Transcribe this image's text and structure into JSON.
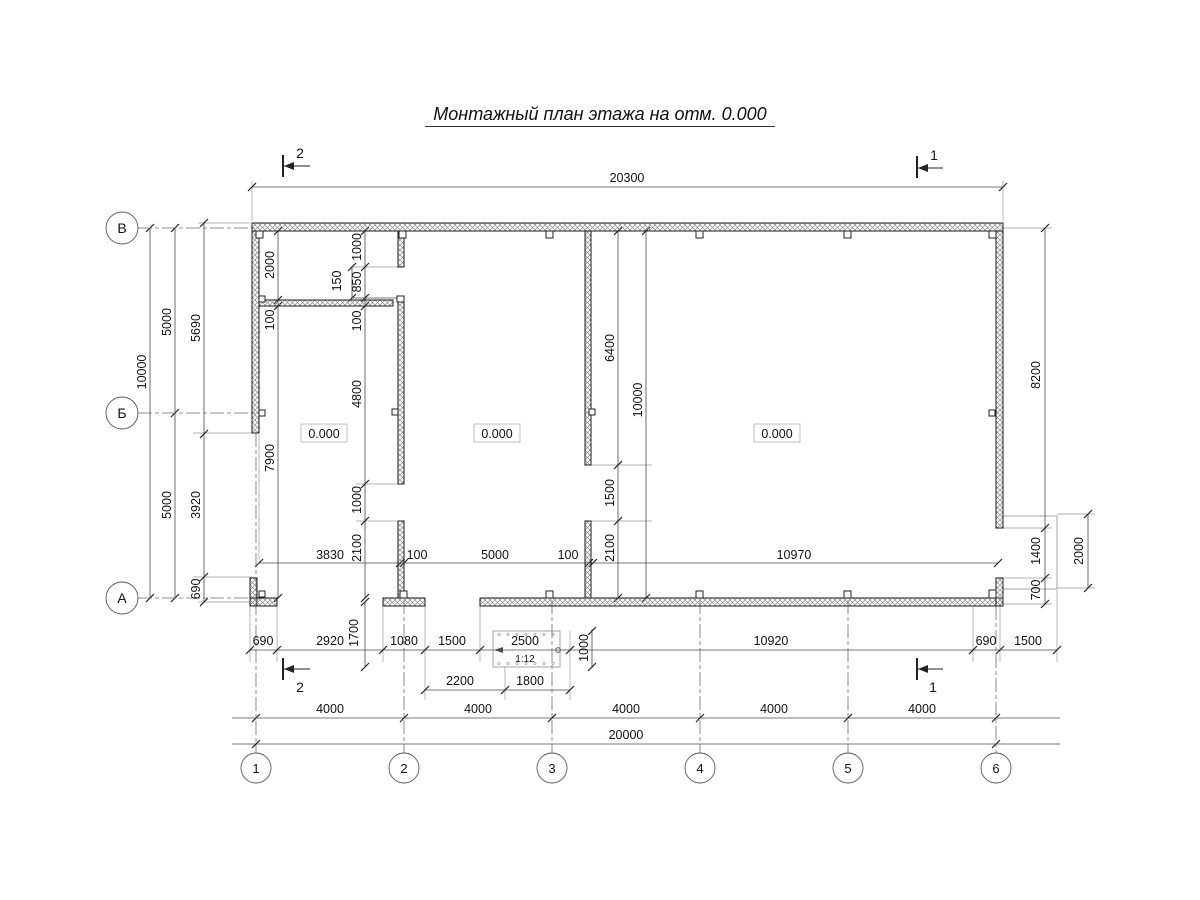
{
  "title": "Монтажный план этажа на отм. 0.000",
  "level_label": "0.000",
  "ramp_slope": "1:12",
  "plan": {
    "colors": {
      "wall_stroke": "#1a1a1a",
      "hatch": "#8a8a8a",
      "dim": "#4a4a4a",
      "ext": "#9a9a9a",
      "axis": "#6f6f6f",
      "tick": "#222222",
      "box": "#b5b5b5"
    },
    "walls": [
      [
        252,
        223,
        751,
        8
      ],
      [
        252,
        231,
        7,
        202
      ],
      [
        250,
        578,
        7,
        28
      ],
      [
        250,
        598,
        27,
        8
      ],
      [
        383,
        598,
        42,
        8
      ],
      [
        480,
        598,
        523,
        8
      ],
      [
        996,
        231,
        7,
        297
      ],
      [
        996,
        578,
        7,
        28
      ],
      [
        398,
        231,
        6,
        36
      ],
      [
        398,
        296,
        6,
        188
      ],
      [
        398,
        521,
        6,
        77
      ],
      [
        585,
        231,
        6,
        234
      ],
      [
        585,
        521,
        6,
        77
      ],
      [
        259,
        300,
        134,
        6
      ]
    ],
    "columns": [
      [
        256,
        231,
        7,
        7
      ],
      [
        399,
        231,
        7,
        7
      ],
      [
        546,
        231,
        7,
        7
      ],
      [
        696,
        231,
        7,
        7
      ],
      [
        844,
        231,
        7,
        7
      ],
      [
        989,
        231,
        7,
        7
      ],
      [
        259,
        410,
        6,
        6
      ],
      [
        989,
        410,
        6,
        6
      ],
      [
        392,
        409,
        6,
        6
      ],
      [
        589,
        409,
        6,
        6
      ],
      [
        259,
        296,
        6,
        6
      ],
      [
        397,
        296,
        7,
        6
      ],
      [
        259,
        591,
        6,
        6
      ],
      [
        400,
        591,
        7,
        7
      ],
      [
        546,
        591,
        7,
        7
      ],
      [
        696,
        591,
        7,
        7
      ],
      [
        844,
        591,
        7,
        7
      ],
      [
        989,
        590,
        7,
        8
      ]
    ],
    "v_axes": [
      {
        "label": "1",
        "x": 256,
        "y1": 433,
        "y2": 753
      },
      {
        "label": "2",
        "x": 404,
        "y1": 600,
        "y2": 753
      },
      {
        "label": "3",
        "x": 552,
        "y1": 600,
        "y2": 753
      },
      {
        "label": "4",
        "x": 700,
        "y1": 600,
        "y2": 753
      },
      {
        "label": "5",
        "x": 848,
        "y1": 600,
        "y2": 753
      },
      {
        "label": "6",
        "x": 996,
        "y1": 606,
        "y2": 753
      }
    ],
    "v_axis_circle_y": 768,
    "h_axes": [
      {
        "label": "В",
        "y": 228,
        "x1": 138,
        "x2": 259
      },
      {
        "label": "Б",
        "y": 413,
        "x1": 138,
        "x2": 259
      },
      {
        "label": "А",
        "y": 598,
        "x1": 138,
        "x2": 252
      }
    ],
    "h_axis_circle_x": 122,
    "dim_lines": [
      {
        "x1": 252,
        "y1": 187,
        "x2": 1003,
        "y2": 187,
        "ticks": [
          [
            252,
            187
          ],
          [
            1003,
            187
          ]
        ]
      },
      {
        "x1": 259,
        "y1": 563,
        "x2": 998,
        "y2": 563,
        "ticks": [
          [
            259,
            563
          ],
          [
            400,
            563
          ],
          [
            404,
            563
          ],
          [
            589,
            563
          ],
          [
            593,
            563
          ],
          [
            998,
            563
          ]
        ]
      },
      {
        "x1": 250,
        "y1": 650,
        "x2": 1057,
        "y2": 650,
        "ticks": [
          [
            250,
            650
          ],
          [
            277,
            650
          ],
          [
            383,
            650
          ],
          [
            425,
            650
          ],
          [
            480,
            650
          ],
          [
            570,
            650
          ],
          [
            973,
            650
          ],
          [
            1000,
            650
          ],
          [
            1057,
            650
          ]
        ]
      },
      {
        "x1": 425,
        "y1": 690,
        "x2": 570,
        "y2": 690,
        "ticks": [
          [
            425,
            690
          ],
          [
            505,
            690
          ],
          [
            570,
            690
          ]
        ]
      },
      {
        "x1": 232,
        "y1": 718,
        "x2": 1060,
        "y2": 718,
        "ticks": [
          [
            256,
            718
          ],
          [
            404,
            718
          ],
          [
            552,
            718
          ],
          [
            700,
            718
          ],
          [
            848,
            718
          ],
          [
            996,
            718
          ]
        ]
      },
      {
        "x1": 232,
        "y1": 744,
        "x2": 1060,
        "y2": 744,
        "ticks": [
          [
            256,
            744
          ],
          [
            996,
            744
          ]
        ]
      },
      {
        "x1": 150,
        "y1": 228,
        "x2": 150,
        "y2": 598,
        "ticks": [
          [
            150,
            228
          ],
          [
            150,
            598
          ]
        ]
      },
      {
        "x1": 175,
        "y1": 228,
        "x2": 175,
        "y2": 598,
        "ticks": [
          [
            175,
            228
          ],
          [
            175,
            413
          ],
          [
            175,
            598
          ]
        ]
      },
      {
        "x1": 204,
        "y1": 223,
        "x2": 204,
        "y2": 602,
        "ticks": [
          [
            204,
            223
          ],
          [
            204,
            434
          ],
          [
            204,
            577
          ],
          [
            204,
            602
          ]
        ]
      },
      {
        "x1": 278,
        "y1": 231,
        "x2": 278,
        "y2": 598,
        "ticks": [
          [
            278,
            231
          ],
          [
            278,
            300
          ],
          [
            278,
            306
          ],
          [
            278,
            598
          ]
        ]
      },
      {
        "x1": 365,
        "y1": 231,
        "x2": 365,
        "y2": 598,
        "ticks": [
          [
            365,
            231
          ],
          [
            365,
            267
          ],
          [
            365,
            298
          ],
          [
            365,
            306
          ],
          [
            365,
            484
          ],
          [
            365,
            521
          ],
          [
            365,
            598
          ]
        ]
      },
      {
        "x1": 352,
        "y1": 267,
        "x2": 352,
        "y2": 298,
        "ticks": [
          [
            352,
            267
          ],
          [
            352,
            298
          ]
        ]
      },
      {
        "x1": 352,
        "y1": 298,
        "x2": 397,
        "y2": 298,
        "ticks": []
      },
      {
        "x1": 618,
        "y1": 231,
        "x2": 618,
        "y2": 598,
        "ticks": [
          [
            618,
            231
          ],
          [
            618,
            465
          ],
          [
            618,
            521
          ],
          [
            618,
            598
          ]
        ]
      },
      {
        "x1": 646,
        "y1": 231,
        "x2": 646,
        "y2": 598,
        "ticks": [
          [
            646,
            231
          ],
          [
            646,
            598
          ]
        ]
      },
      {
        "x1": 365,
        "y1": 602,
        "x2": 365,
        "y2": 667,
        "ticks": [
          [
            365,
            602
          ],
          [
            365,
            667
          ]
        ]
      },
      {
        "x1": 592,
        "y1": 629,
        "x2": 592,
        "y2": 668,
        "ticks": [
          [
            592,
            631
          ],
          [
            592,
            667
          ]
        ]
      },
      {
        "x1": 1045,
        "y1": 228,
        "x2": 1045,
        "y2": 604,
        "ticks": [
          [
            1045,
            228
          ],
          [
            1045,
            528
          ],
          [
            1045,
            578
          ],
          [
            1045,
            604
          ]
        ]
      },
      {
        "x1": 1088,
        "y1": 514,
        "x2": 1088,
        "y2": 588,
        "ticks": [
          [
            1088,
            514
          ],
          [
            1088,
            588
          ]
        ]
      }
    ],
    "ext_lines": [
      [
        252,
        221,
        252,
        181
      ],
      [
        1003,
        221,
        1003,
        181
      ],
      [
        250,
        223,
        198,
        223
      ],
      [
        259,
        433,
        193,
        433
      ],
      [
        252,
        577,
        193,
        577
      ],
      [
        250,
        602,
        198,
        602
      ],
      [
        404,
        267,
        350,
        267
      ],
      [
        398,
        484,
        356,
        484
      ],
      [
        398,
        521,
        356,
        521
      ],
      [
        591,
        465,
        652,
        465
      ],
      [
        591,
        521,
        652,
        521
      ],
      [
        259,
        435,
        259,
        560
      ],
      [
        250,
        606,
        250,
        662
      ],
      [
        277,
        606,
        277,
        662
      ],
      [
        383,
        606,
        383,
        662
      ],
      [
        425,
        606,
        425,
        700
      ],
      [
        480,
        606,
        480,
        662
      ],
      [
        505,
        667,
        505,
        700
      ],
      [
        570,
        631,
        570,
        700
      ],
      [
        973,
        606,
        973,
        662
      ],
      [
        1000,
        606,
        1000,
        662
      ],
      [
        1057,
        590,
        1057,
        662
      ],
      [
        1003,
        228,
        1052,
        228
      ],
      [
        1003,
        528,
        1052,
        528
      ],
      [
        1003,
        578,
        1052,
        578
      ],
      [
        1003,
        604,
        1052,
        604
      ],
      [
        1057,
        514,
        1095,
        514
      ],
      [
        1057,
        588,
        1095,
        588
      ]
    ],
    "platform_lines": [
      [
        1003,
        516,
        1057,
        516
      ],
      [
        1057,
        516,
        1057,
        589
      ],
      [
        1003,
        589,
        1057,
        589
      ]
    ],
    "dim_labels": [
      {
        "t": "20300",
        "x": 627,
        "y": 182,
        "r": 0
      },
      {
        "t": "3830",
        "x": 330,
        "y": 559,
        "r": 0
      },
      {
        "t": "100",
        "x": 417,
        "y": 559,
        "r": 0
      },
      {
        "t": "5000",
        "x": 495,
        "y": 559,
        "r": 0
      },
      {
        "t": "100",
        "x": 568,
        "y": 559,
        "r": 0
      },
      {
        "t": "10970",
        "x": 794,
        "y": 559,
        "r": 0
      },
      {
        "t": "690",
        "x": 263,
        "y": 645,
        "r": 0
      },
      {
        "t": "2920",
        "x": 330,
        "y": 645,
        "r": 0
      },
      {
        "t": "1080",
        "x": 404,
        "y": 645,
        "r": 0
      },
      {
        "t": "1500",
        "x": 452,
        "y": 645,
        "r": 0
      },
      {
        "t": "2500",
        "x": 525,
        "y": 645,
        "r": 0
      },
      {
        "t": "10920",
        "x": 771,
        "y": 645,
        "r": 0
      },
      {
        "t": "690",
        "x": 986,
        "y": 645,
        "r": 0
      },
      {
        "t": "1500",
        "x": 1028,
        "y": 645,
        "r": 0
      },
      {
        "t": "1:12",
        "x": 525,
        "y": 662,
        "r": 0,
        "s": 10
      },
      {
        "t": "2200",
        "x": 460,
        "y": 685,
        "r": 0
      },
      {
        "t": "1800",
        "x": 530,
        "y": 685,
        "r": 0
      },
      {
        "t": "4000",
        "x": 330,
        "y": 713,
        "r": 0
      },
      {
        "t": "4000",
        "x": 478,
        "y": 713,
        "r": 0
      },
      {
        "t": "4000",
        "x": 626,
        "y": 713,
        "r": 0
      },
      {
        "t": "4000",
        "x": 774,
        "y": 713,
        "r": 0
      },
      {
        "t": "4000",
        "x": 922,
        "y": 713,
        "r": 0
      },
      {
        "t": "20000",
        "x": 626,
        "y": 739,
        "r": 0
      },
      {
        "t": "10000",
        "x": 146,
        "y": 372,
        "r": 1
      },
      {
        "t": "5000",
        "x": 171,
        "y": 322,
        "r": 1
      },
      {
        "t": "5000",
        "x": 171,
        "y": 505,
        "r": 1
      },
      {
        "t": "5690",
        "x": 200,
        "y": 328,
        "r": 1
      },
      {
        "t": "3920",
        "x": 200,
        "y": 505,
        "r": 1
      },
      {
        "t": "690",
        "x": 200,
        "y": 589,
        "r": 1
      },
      {
        "t": "2000",
        "x": 274,
        "y": 265,
        "r": 1
      },
      {
        "t": "100",
        "x": 274,
        "y": 320,
        "r": 1
      },
      {
        "t": "7900",
        "x": 274,
        "y": 458,
        "r": 1
      },
      {
        "t": "1000",
        "x": 361,
        "y": 247,
        "r": 1
      },
      {
        "t": "850",
        "x": 361,
        "y": 282,
        "r": 1
      },
      {
        "t": "150",
        "x": 341,
        "y": 281,
        "r": 1
      },
      {
        "t": "100",
        "x": 361,
        "y": 321,
        "r": 1
      },
      {
        "t": "4800",
        "x": 361,
        "y": 394,
        "r": 1
      },
      {
        "t": "1000",
        "x": 361,
        "y": 500,
        "r": 1
      },
      {
        "t": "2100",
        "x": 361,
        "y": 548,
        "r": 1
      },
      {
        "t": "1700",
        "x": 358,
        "y": 633,
        "r": 1
      },
      {
        "t": "6400",
        "x": 614,
        "y": 348,
        "r": 1
      },
      {
        "t": "1500",
        "x": 614,
        "y": 493,
        "r": 1
      },
      {
        "t": "2100",
        "x": 614,
        "y": 548,
        "r": 1
      },
      {
        "t": "10000",
        "x": 642,
        "y": 400,
        "r": 1
      },
      {
        "t": "1000",
        "x": 588,
        "y": 648,
        "r": 1
      },
      {
        "t": "8200",
        "x": 1040,
        "y": 375,
        "r": 1
      },
      {
        "t": "1400",
        "x": 1040,
        "y": 551,
        "r": 1
      },
      {
        "t": "700",
        "x": 1040,
        "y": 590,
        "r": 1
      },
      {
        "t": "2000",
        "x": 1083,
        "y": 551,
        "r": 1
      }
    ],
    "section_markers": [
      {
        "label": "2",
        "bx": 283,
        "by1": 155,
        "by2": 177,
        "ly": 166,
        "lx2": 310,
        "tx": 300,
        "ty": 158
      },
      {
        "label": "1",
        "bx": 917,
        "by1": 156,
        "by2": 178,
        "ly": 168,
        "lx2": 943,
        "tx": 934,
        "ty": 160
      },
      {
        "label": "2",
        "bx": 283,
        "by1": 658,
        "by2": 680,
        "ly": 669,
        "lx2": 310,
        "tx": 300,
        "ty": 692
      },
      {
        "label": "1",
        "bx": 917,
        "by1": 658,
        "by2": 680,
        "ly": 669,
        "lx2": 943,
        "tx": 933,
        "ty": 692
      }
    ],
    "levels": [
      {
        "x": 324,
        "y": 434
      },
      {
        "x": 497,
        "y": 434
      },
      {
        "x": 777,
        "y": 434
      }
    ],
    "ramp": {
      "rect": [
        493,
        631,
        67,
        36
      ],
      "dot_rows": [
        634.5,
        663.5
      ],
      "dot_xs": [
        499,
        508,
        517,
        526,
        535,
        544,
        553
      ],
      "arrow_tip": [
        494,
        650
      ],
      "arrow_back": [
        503,
        647,
        503,
        653
      ],
      "circle": [
        558,
        650
      ]
    }
  }
}
